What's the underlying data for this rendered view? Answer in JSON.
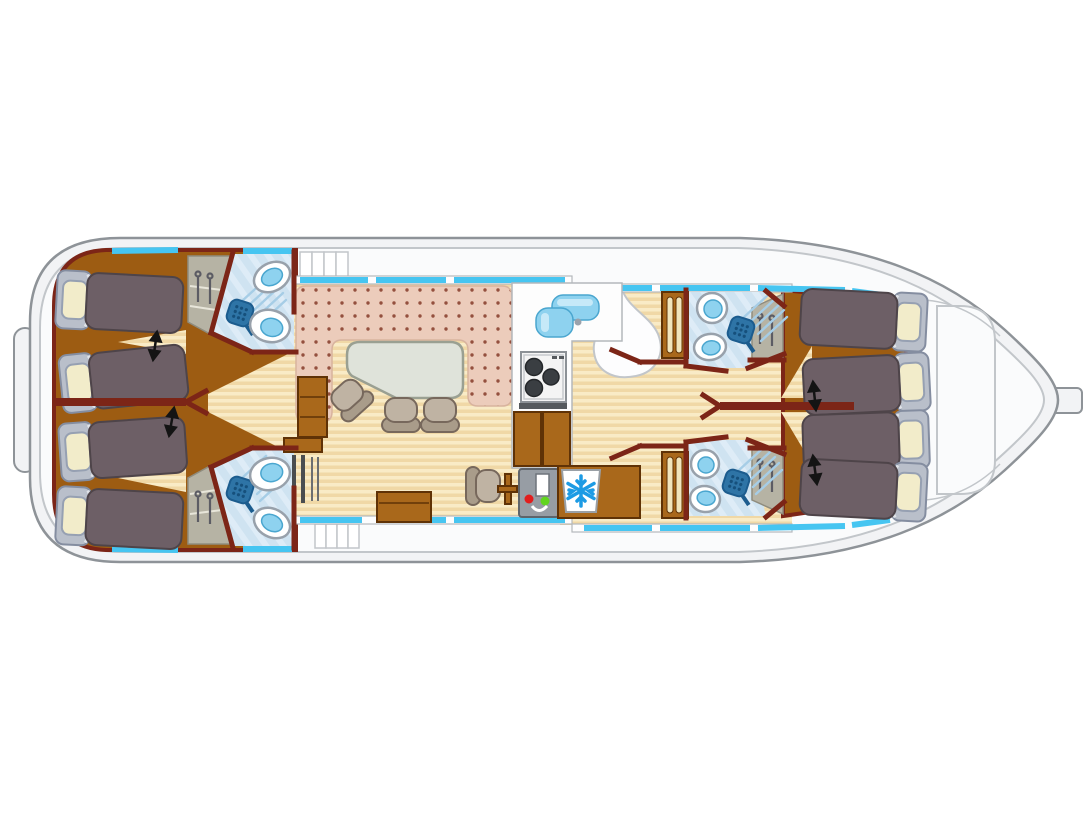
{
  "description": "Top-down floor plan of a canal houseboat",
  "palette": {
    "deck": "#f2f3f5",
    "deck_inner": "#fafbfc",
    "hull_line": "#8e9398",
    "hull_line_light": "#c2c6ca",
    "wall_edge": "#b4b8bc",
    "window_blue": "#46c5f1",
    "wall_maroon": "#7c2517",
    "cabin_floor": "#9d5c12",
    "wood": "#a9681b",
    "wood_dark": "#5f3206",
    "cream": "#f1e5bd",
    "floor_a": "#f9ebc6",
    "floor_b": "#f0d8a6",
    "carpet": "#ecccbb",
    "carpet_dot": "#94503e",
    "carpet_edge": "#d8b39e",
    "bath_floor": "#cfe3f1",
    "bath_floor_light": "#deecf7",
    "fixture_edge": "#98a1ab",
    "water": "#8ed2ef",
    "water_deep": "#4aa6cf",
    "mattress": "#6d5f66",
    "mattress_edge": "#4e4449",
    "headboard": "#b9bfca",
    "headboard_edge": "#848da0",
    "pillow": "#f2ecca",
    "pillow_edge": "#96a0b2",
    "table_top": "#dfe3da",
    "table_edge": "#9aa092",
    "chair": "#bfb3a3",
    "chair_back": "#a99c8a",
    "chair_edge": "#77685c",
    "wardrobe": "#b6b3a4",
    "wardrobe_edge": "#8f8c7e",
    "hanger": "#5c5c64",
    "shower": "#2e74a6",
    "shower_spray": "#a6cde6",
    "console": "#979da4",
    "console_edge": "#5e646b",
    "led_red": "#e21d1d",
    "led_green": "#62d51f",
    "snowflake": "#1d9be4",
    "steel": "#55595d",
    "arrow": "#141414"
  },
  "inventory": {
    "cabins": 4,
    "single_berths": 8,
    "pillows": 8,
    "convertible_bed_arrows": 4,
    "shower_rooms": 4,
    "toilets": 4,
    "washbasins": 4,
    "shower_heads": 4,
    "wardrobes": 4,
    "salon_chairs": 3,
    "dinette_tables": 1,
    "helm_seats": 1,
    "helm_consoles": 1,
    "steering_wheels": 1,
    "hob_burners": 3,
    "sink_basins": 2,
    "fridges": 1,
    "companionway_steps": 2,
    "mid_cabinets": 2,
    "radiators": 1,
    "sideboards": 2
  },
  "icons": [
    "snowflake-icon",
    "shower-head-icon",
    "hanger-icon",
    "double-arrow-icon",
    "burner-icon"
  ]
}
